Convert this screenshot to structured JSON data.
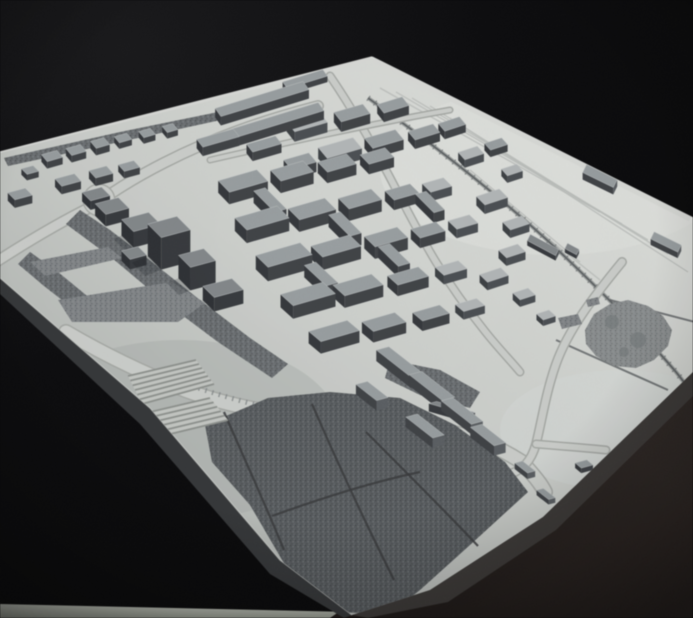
{
  "meta": {
    "kind": "photograph",
    "subject": "monochrome architectural urban massing model on a white baseboard, black backdrop",
    "width": 693,
    "height": 618
  },
  "colors": {
    "bg0": "#161618",
    "bg1": "#09090b",
    "plate_hi": "#e0e2de",
    "plate_mid": "#cfd2ce",
    "plate_lo": "#afb3b0",
    "side_left": "#343638",
    "side_right": "#3b3836",
    "fg0": "#2c2421",
    "fg1": "#1c1715",
    "strip0": "#c6cabf",
    "strip1": "#969b90",
    "road_casing": "#a9aca8",
    "road_fill": "#ced1cd",
    "rim_road": "#dadcd8",
    "rail_bed": "#9ea2a0",
    "rail_line": "#5b5f61",
    "rail_tick": "#6b6f71",
    "siding": "#bcc0bc",
    "park_base": "#6b6f72",
    "park_dark": "#585c5f",
    "path_line": "#383a3c",
    "blob_fill": "#8d9192",
    "stone_fill": "#83878a",
    "zebra_base": "#c6c9c5",
    "zebra_stripe": "#8f938f",
    "edge_hi_top": "#eceeea",
    "edge_hi_bottom": "#d8dbd7",
    "shadow": "#14161a"
  },
  "geometry": {
    "plate": [
      [
        0,
        152
      ],
      [
        372,
        57
      ],
      [
        693,
        218
      ],
      [
        693,
        372
      ],
      [
        543,
        517
      ],
      [
        430,
        590
      ],
      [
        352,
        615
      ],
      [
        280,
        560
      ],
      [
        150,
        408
      ],
      [
        0,
        278
      ]
    ],
    "side_left": [
      [
        0,
        278
      ],
      [
        150,
        408
      ],
      [
        280,
        560
      ],
      [
        352,
        615
      ],
      [
        344,
        618
      ],
      [
        270,
        574
      ],
      [
        140,
        424
      ],
      [
        0,
        294
      ]
    ],
    "side_right": [
      [
        693,
        372
      ],
      [
        543,
        517
      ],
      [
        430,
        590
      ],
      [
        352,
        615
      ],
      [
        368,
        618
      ],
      [
        448,
        602
      ],
      [
        556,
        530
      ],
      [
        693,
        396
      ]
    ],
    "foreground": [
      [
        330,
        618
      ],
      [
        693,
        368
      ],
      [
        693,
        618
      ]
    ],
    "floor_strip": [
      [
        0,
        604
      ],
      [
        352,
        612
      ],
      [
        352,
        618
      ],
      [
        0,
        618
      ]
    ],
    "top_edge_lines": [
      [
        0,
        152,
        372,
        57
      ],
      [
        372,
        57,
        693,
        218
      ]
    ],
    "bottom_edge_line": [
      [
        0,
        278
      ],
      [
        150,
        408
      ],
      [
        280,
        560
      ],
      [
        352,
        615
      ]
    ],
    "bright_spots": [
      {
        "cx": 555,
        "cy": 170,
        "rx": 175,
        "ry": 85,
        "fill": "#e4e6e2",
        "op": 0.55
      },
      {
        "cx": 180,
        "cy": 430,
        "rx": 160,
        "ry": 90,
        "fill": "#a8aca9",
        "op": 0.4
      },
      {
        "cx": 620,
        "cy": 430,
        "rx": 120,
        "ry": 60,
        "fill": "#dadddb",
        "op": 0.45
      }
    ]
  },
  "roads": [
    {
      "d": "M -4 262 C 30 240 60 222 95 205 C 135 175 190 148 240 130 C 270 119 295 112 318 106",
      "w": 9
    },
    {
      "d": "M 66 332 C 100 352 140 372 185 390 C 255 416 330 420 420 428 C 470 432 500 448 522 462 C 536 478 541 484 545 492",
      "w": 13
    },
    {
      "d": "M 330 76 C 352 108 370 140 387 172 C 404 204 420 236 436 262 C 452 288 468 310 484 330 C 498 348 512 362 520 372",
      "w": 6
    },
    {
      "d": "M 622 262 C 594 296 568 330 556 364 C 546 392 542 420 536 444 C 531 462 522 470 510 474",
      "w": 7
    },
    {
      "d": "M 536 444 C 560 446 586 448 606 450",
      "w": 6
    },
    {
      "d": "M 210 160 C 290 142 370 124 450 110",
      "w": 4
    }
  ],
  "rim_roads": [
    {
      "d": "M 2 150 L 370 58",
      "w": 5
    },
    {
      "d": "M 374 60 L 690 219",
      "w": 5
    }
  ],
  "roundabout": {
    "cx": 99,
    "cy": 200,
    "r": 12
  },
  "avenue_ticks": {
    "d": "M 192 386 C 240 402 290 414 338 424",
    "w": 5,
    "dash": "1.5 5.5",
    "color": "#85898b",
    "op": 0.8
  },
  "rails": {
    "main": "M 368 98 C 430 142 500 196 560 252 C 600 290 640 330 676 372 C 684 382 690 390 695 396",
    "sidings": [
      "M 380 88 L 600 212",
      "M 396 92 L 622 224",
      "M 412 98 L 648 240",
      "M 430 106 L 668 254",
      "M 450 118 L 688 272",
      "M 470 170 L 580 262",
      "M 500 200 L 600 280"
    ],
    "extra_dark": [
      "M 556 340 L 668 390",
      "M 610 300 L 695 322"
    ]
  },
  "parks": [
    {
      "name": "boulevard-band",
      "pts": [
        [
          80,
          210
        ],
        [
          110,
          230
        ],
        [
          152,
          262
        ],
        [
          200,
          300
        ],
        [
          250,
          338
        ],
        [
          288,
          364
        ],
        [
          272,
          378
        ],
        [
          218,
          342
        ],
        [
          162,
          300
        ],
        [
          112,
          258
        ],
        [
          66,
          224
        ]
      ]
    },
    {
      "name": "inner-crescent",
      "pts": [
        [
          30,
          252
        ],
        [
          58,
          272
        ],
        [
          92,
          300
        ],
        [
          80,
          314
        ],
        [
          44,
          286
        ],
        [
          18,
          264
        ]
      ]
    },
    {
      "name": "rim-slope",
      "pts": [
        [
          4,
          158
        ],
        [
          120,
          132
        ],
        [
          228,
          110
        ],
        [
          230,
          118
        ],
        [
          124,
          141
        ],
        [
          8,
          166
        ]
      ]
    },
    {
      "name": "big-park",
      "pts": [
        [
          205,
          425
        ],
        [
          268,
          398
        ],
        [
          330,
          392
        ],
        [
          400,
          398
        ],
        [
          455,
          425
        ],
        [
          505,
          462
        ],
        [
          528,
          492
        ],
        [
          470,
          545
        ],
        [
          420,
          590
        ],
        [
          390,
          614
        ],
        [
          332,
          612
        ],
        [
          285,
          565
        ],
        [
          250,
          505
        ],
        [
          212,
          462
        ]
      ],
      "dark": true
    },
    {
      "name": "bars-patch",
      "pts": [
        [
          390,
          360
        ],
        [
          440,
          370
        ],
        [
          480,
          392
        ],
        [
          470,
          408
        ],
        [
          420,
          395
        ],
        [
          385,
          378
        ]
      ]
    }
  ],
  "park_paths": [
    "M 224 412 C 244 458 266 506 284 550",
    "M 312 404 C 338 464 368 528 394 580",
    "M 366 432 C 404 470 444 510 478 546",
    "M 272 516 C 322 498 372 482 420 472"
  ],
  "blob": {
    "pts": [
      [
        585,
        330
      ],
      [
        594,
        314
      ],
      [
        610,
        304
      ],
      [
        628,
        300
      ],
      [
        648,
        306
      ],
      [
        663,
        316
      ],
      [
        672,
        330
      ],
      [
        668,
        346
      ],
      [
        654,
        360
      ],
      [
        636,
        368
      ],
      [
        614,
        366
      ],
      [
        596,
        356
      ],
      [
        586,
        344
      ]
    ],
    "spots": [
      [
        612,
        322,
        7
      ],
      [
        638,
        340,
        8
      ],
      [
        624,
        352,
        5
      ]
    ]
  },
  "stones": [
    [
      [
        30,
        262
      ],
      [
        108,
        247
      ],
      [
        122,
        258
      ],
      [
        45,
        276
      ]
    ],
    [
      [
        58,
        300
      ],
      [
        172,
        282
      ],
      [
        205,
        303
      ],
      [
        178,
        322
      ],
      [
        72,
        322
      ]
    ],
    [
      [
        558,
        318
      ],
      [
        578,
        314
      ],
      [
        582,
        324
      ],
      [
        562,
        329
      ]
    ],
    [
      [
        586,
        300
      ],
      [
        598,
        297
      ],
      [
        600,
        304
      ],
      [
        588,
        307
      ]
    ]
  ],
  "zebra": [
    {
      "pts": [
        [
          128,
          376
        ],
        [
          196,
          360
        ],
        [
          214,
          384
        ],
        [
          142,
          404
        ]
      ],
      "n": 6
    },
    {
      "pts": [
        [
          150,
          412
        ],
        [
          210,
          398
        ],
        [
          228,
          420
        ],
        [
          162,
          436
        ]
      ],
      "n": 5
    }
  ],
  "buildings": {
    "fields": [
      "x",
      "y",
      "w",
      "d",
      "h",
      "au",
      "av",
      "tone"
    ],
    "tones": {
      "0": {
        "top": "#999fa1",
        "front": "#3e4145",
        "side": "#5a5e62",
        "left": "#33363a"
      },
      "1": {
        "top": "#83888b",
        "front": "#35383c",
        "side": "#4d5155",
        "left": "#2c2f33"
      },
      "2": {
        "top": "#b4b8b9",
        "front": "#4a4e52",
        "side": "#6a6e72",
        "left": "#3b3f43"
      }
    },
    "items": [
      [
        52,
        163,
        16,
        9,
        7,
        -16,
        50,
        0
      ],
      [
        76,
        157,
        15,
        9,
        7,
        -16,
        50,
        0
      ],
      [
        100,
        150,
        14,
        9,
        7,
        -16,
        50,
        0
      ],
      [
        123,
        144,
        13,
        8,
        6,
        -16,
        50,
        0
      ],
      [
        147,
        139,
        12,
        8,
        6,
        -16,
        50,
        0
      ],
      [
        170,
        134,
        11,
        8,
        6,
        -16,
        50,
        0
      ],
      [
        68,
        188,
        20,
        10,
        8,
        -15,
        48,
        0
      ],
      [
        101,
        180,
        18,
        10,
        8,
        -15,
        48,
        0
      ],
      [
        129,
        173,
        16,
        9,
        7,
        -15,
        48,
        0
      ],
      [
        20,
        202,
        18,
        10,
        8,
        -15,
        45,
        0
      ],
      [
        30,
        176,
        12,
        8,
        6,
        -15,
        45,
        0
      ],
      [
        262,
        108,
        92,
        10,
        9,
        -17,
        55,
        0
      ],
      [
        277,
        129,
        92,
        10,
        9,
        -17,
        55,
        0
      ],
      [
        305,
        85,
        42,
        8,
        6,
        -17,
        55,
        0
      ],
      [
        218,
        147,
        38,
        10,
        9,
        -16,
        52,
        0
      ],
      [
        264,
        153,
        30,
        10,
        9,
        -16,
        52,
        0
      ],
      [
        307,
        132,
        34,
        13,
        10,
        -16,
        52,
        2
      ],
      [
        352,
        123,
        30,
        12,
        10,
        -16,
        52,
        0
      ],
      [
        393,
        114,
        26,
        11,
        9,
        -17,
        52,
        0
      ],
      [
        340,
        159,
        36,
        14,
        11,
        -16,
        50,
        2
      ],
      [
        384,
        149,
        32,
        13,
        10,
        -16,
        50,
        0
      ],
      [
        424,
        141,
        26,
        11,
        9,
        -17,
        50,
        0
      ],
      [
        300,
        171,
        26,
        12,
        10,
        -16,
        50,
        0
      ],
      [
        452,
        132,
        22,
        10,
        8,
        -18,
        50,
        0
      ],
      [
        471,
        161,
        20,
        10,
        8,
        -18,
        48,
        2
      ],
      [
        496,
        151,
        18,
        9,
        7,
        -18,
        48,
        0
      ],
      [
        512,
        177,
        16,
        9,
        7,
        -18,
        48,
        2
      ],
      [
        96,
        203,
        20,
        12,
        9,
        -15,
        45,
        1
      ],
      [
        112,
        218,
        24,
        15,
        12,
        -15,
        45,
        1
      ],
      [
        141,
        238,
        28,
        17,
        16,
        -15,
        45,
        1
      ],
      [
        169,
        259,
        30,
        19,
        32,
        -15,
        45,
        1
      ],
      [
        197,
        281,
        26,
        17,
        23,
        -15,
        45,
        1
      ],
      [
        134,
        263,
        17,
        12,
        10,
        -15,
        45,
        1
      ],
      [
        223,
        302,
        30,
        16,
        14,
        -15,
        44,
        1
      ],
      [
        243,
        193,
        40,
        16,
        12,
        -16,
        46,
        0
      ],
      [
        292,
        183,
        34,
        15,
        12,
        -16,
        46,
        0
      ],
      [
        337,
        174,
        30,
        14,
        11,
        -16,
        46,
        0
      ],
      [
        377,
        166,
        26,
        13,
        10,
        -16,
        46,
        0
      ],
      [
        262,
        231,
        44,
        17,
        13,
        -16,
        45,
        0
      ],
      [
        312,
        221,
        38,
        16,
        12,
        -16,
        45,
        0
      ],
      [
        360,
        211,
        34,
        15,
        12,
        -16,
        45,
        0
      ],
      [
        402,
        202,
        26,
        13,
        10,
        -16,
        45,
        0
      ],
      [
        437,
        194,
        22,
        12,
        9,
        -16,
        45,
        2
      ],
      [
        284,
        269,
        46,
        17,
        14,
        -16,
        44,
        0
      ],
      [
        336,
        259,
        40,
        16,
        13,
        -16,
        44,
        0
      ],
      [
        386,
        249,
        34,
        15,
        12,
        -16,
        44,
        0
      ],
      [
        428,
        240,
        26,
        13,
        10,
        -16,
        44,
        0
      ],
      [
        463,
        231,
        22,
        12,
        9,
        -16,
        44,
        2
      ],
      [
        308,
        307,
        44,
        17,
        13,
        -16,
        42,
        0
      ],
      [
        358,
        297,
        40,
        16,
        12,
        -16,
        42,
        0
      ],
      [
        408,
        287,
        32,
        14,
        11,
        -16,
        42,
        0
      ],
      [
        451,
        277,
        24,
        12,
        9,
        -16,
        42,
        2
      ],
      [
        334,
        343,
        40,
        16,
        12,
        -16,
        40,
        0
      ],
      [
        384,
        333,
        34,
        15,
        11,
        -16,
        40,
        0
      ],
      [
        431,
        323,
        28,
        13,
        10,
        -16,
        40,
        0
      ],
      [
        470,
        313,
        22,
        11,
        8,
        -16,
        40,
        2
      ],
      [
        270,
        212,
        12,
        30,
        12,
        -16,
        45,
        0
      ],
      [
        345,
        236,
        12,
        30,
        12,
        -16,
        45,
        0
      ],
      [
        394,
        266,
        12,
        28,
        11,
        -16,
        44,
        0
      ],
      [
        321,
        286,
        12,
        30,
        12,
        -16,
        43,
        0
      ],
      [
        430,
        212,
        11,
        26,
        10,
        -16,
        45,
        0
      ],
      [
        492,
        206,
        24,
        12,
        9,
        -18,
        45,
        2
      ],
      [
        516,
        231,
        20,
        11,
        8,
        -18,
        45,
        2
      ],
      [
        512,
        259,
        20,
        11,
        8,
        -18,
        44,
        2
      ],
      [
        494,
        283,
        22,
        11,
        8,
        -18,
        44,
        2
      ],
      [
        524,
        301,
        16,
        10,
        7,
        -18,
        43,
        2
      ],
      [
        546,
        321,
        13,
        9,
        6,
        -18,
        42,
        2
      ],
      [
        400,
        373,
        44,
        13,
        11,
        38,
        165,
        0
      ],
      [
        432,
        397,
        42,
        13,
        11,
        38,
        165,
        0
      ],
      [
        462,
        421,
        38,
        12,
        10,
        38,
        165,
        0
      ],
      [
        425,
        436,
        34,
        12,
        10,
        38,
        165,
        0
      ],
      [
        488,
        445,
        30,
        12,
        10,
        38,
        165,
        0
      ],
      [
        372,
        401,
        26,
        12,
        10,
        38,
        165,
        0
      ],
      [
        452,
        416,
        40,
        8,
        8,
        16,
        165,
        1
      ],
      [
        525,
        473,
        16,
        8,
        6,
        38,
        165,
        0
      ],
      [
        546,
        499,
        15,
        7,
        5,
        38,
        165,
        0
      ],
      [
        565,
        521,
        13,
        7,
        5,
        38,
        165,
        0
      ],
      [
        584,
        469,
        12,
        8,
        5,
        -15,
        40,
        0
      ],
      [
        600,
        183,
        34,
        9,
        7,
        26,
        116,
        0
      ],
      [
        666,
        248,
        30,
        8,
        6,
        26,
        116,
        0
      ],
      [
        543,
        250,
        32,
        7,
        5,
        28,
        116,
        1
      ],
      [
        572,
        253,
        13,
        6,
        4,
        28,
        116,
        1
      ]
    ]
  },
  "photo": {
    "grain_opacity": 0.5,
    "vignette": [
      "rgba(0,0,0,0)",
      "rgba(0,0,0,0.02)",
      "rgba(0,0,0,0.22)",
      "rgba(0,0,0,0.5)"
    ]
  }
}
